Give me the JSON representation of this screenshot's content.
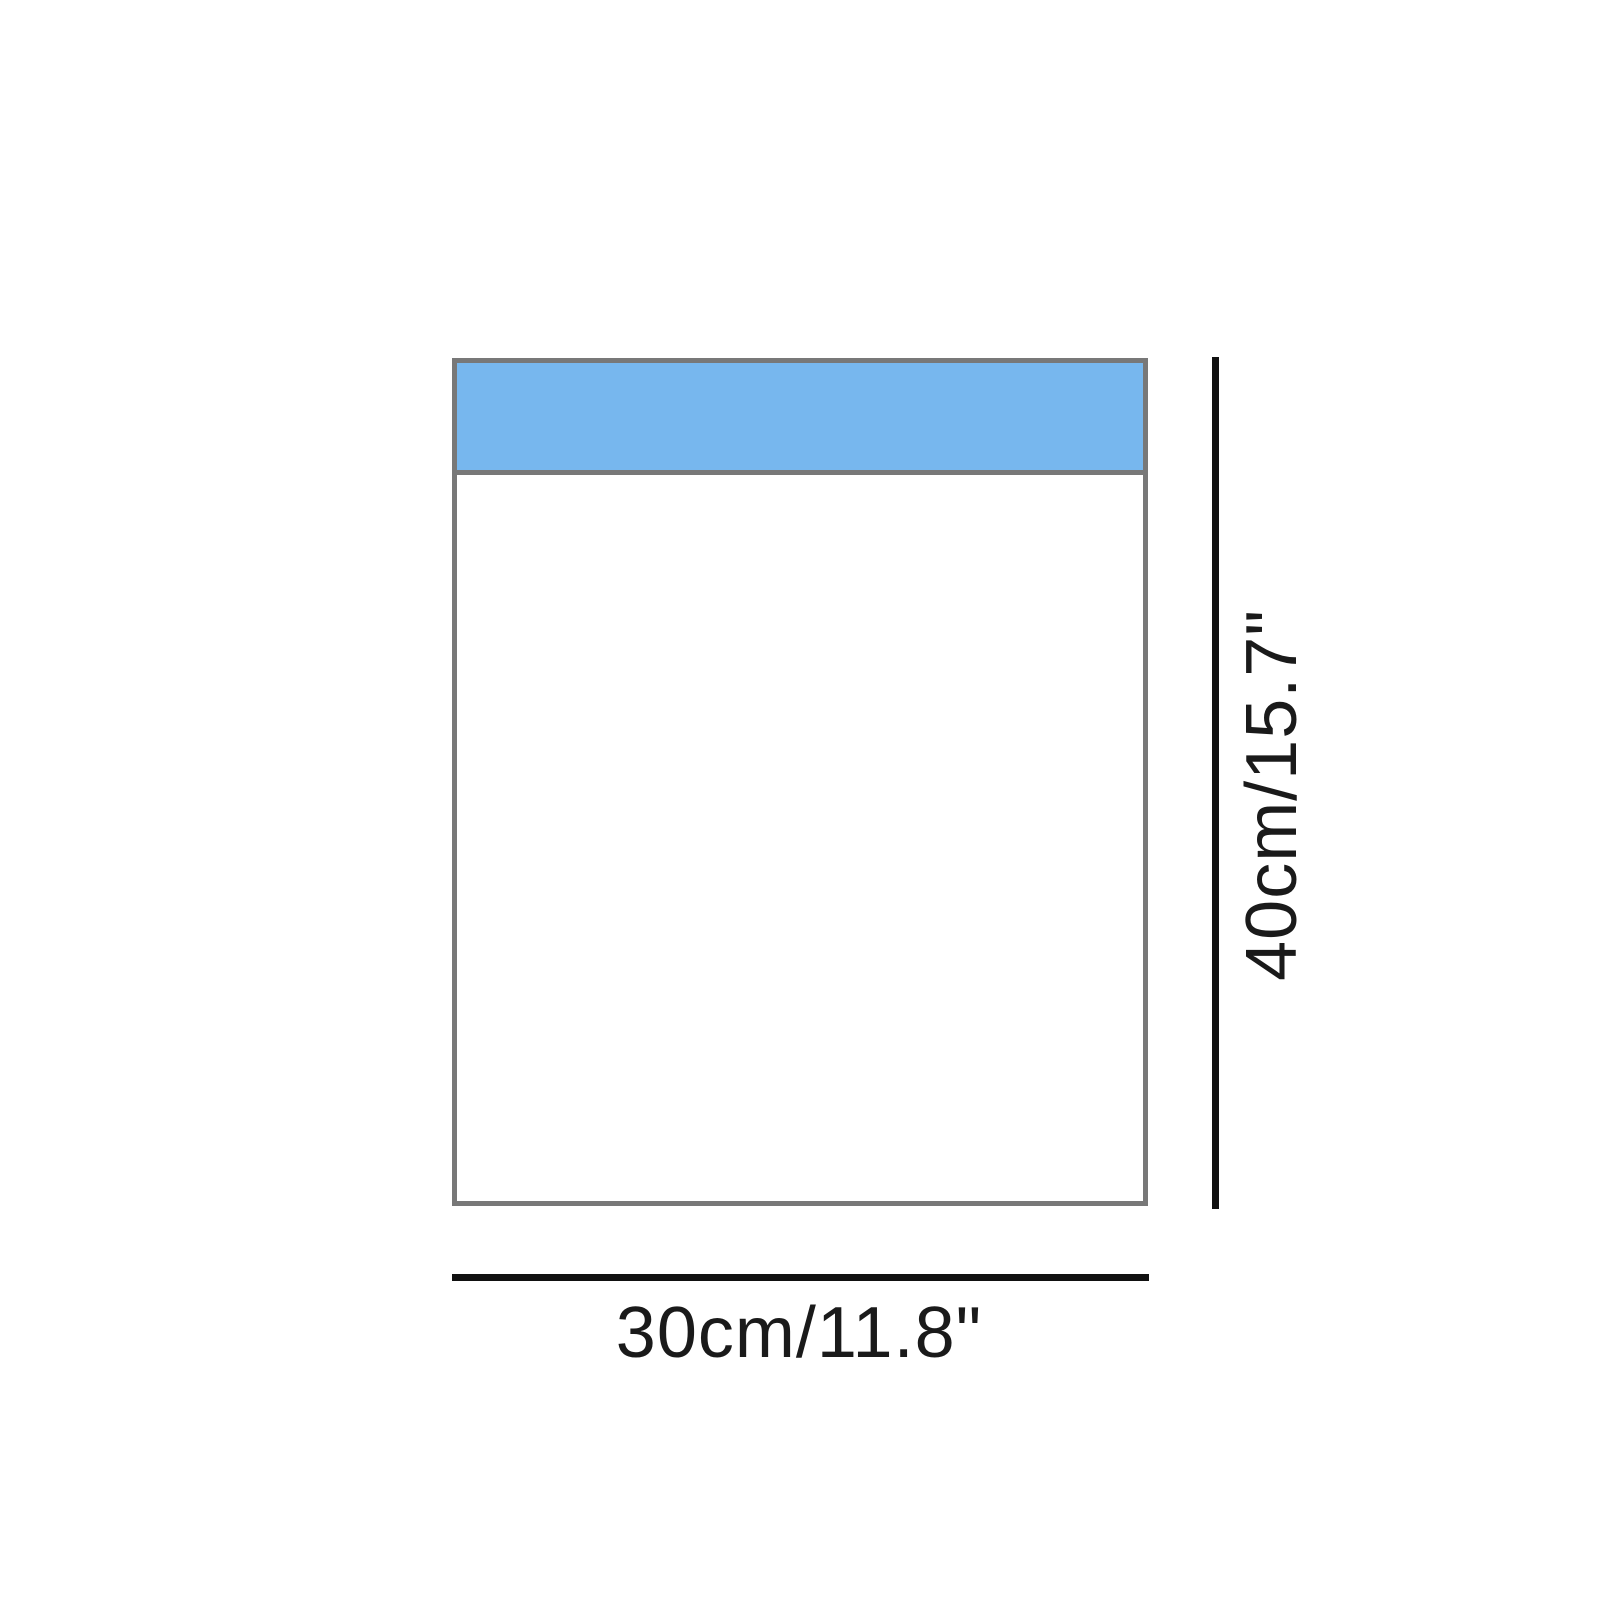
{
  "dimensions": {
    "height_label": "40cm/15.7\"",
    "width_label": "30cm/11.8\""
  },
  "colors": {
    "background": "#ffffff",
    "flap-blue": "#77b7ee",
    "bag-border": "#787878",
    "dimension-line": "#111111",
    "label-text": "#1a1a1a"
  }
}
